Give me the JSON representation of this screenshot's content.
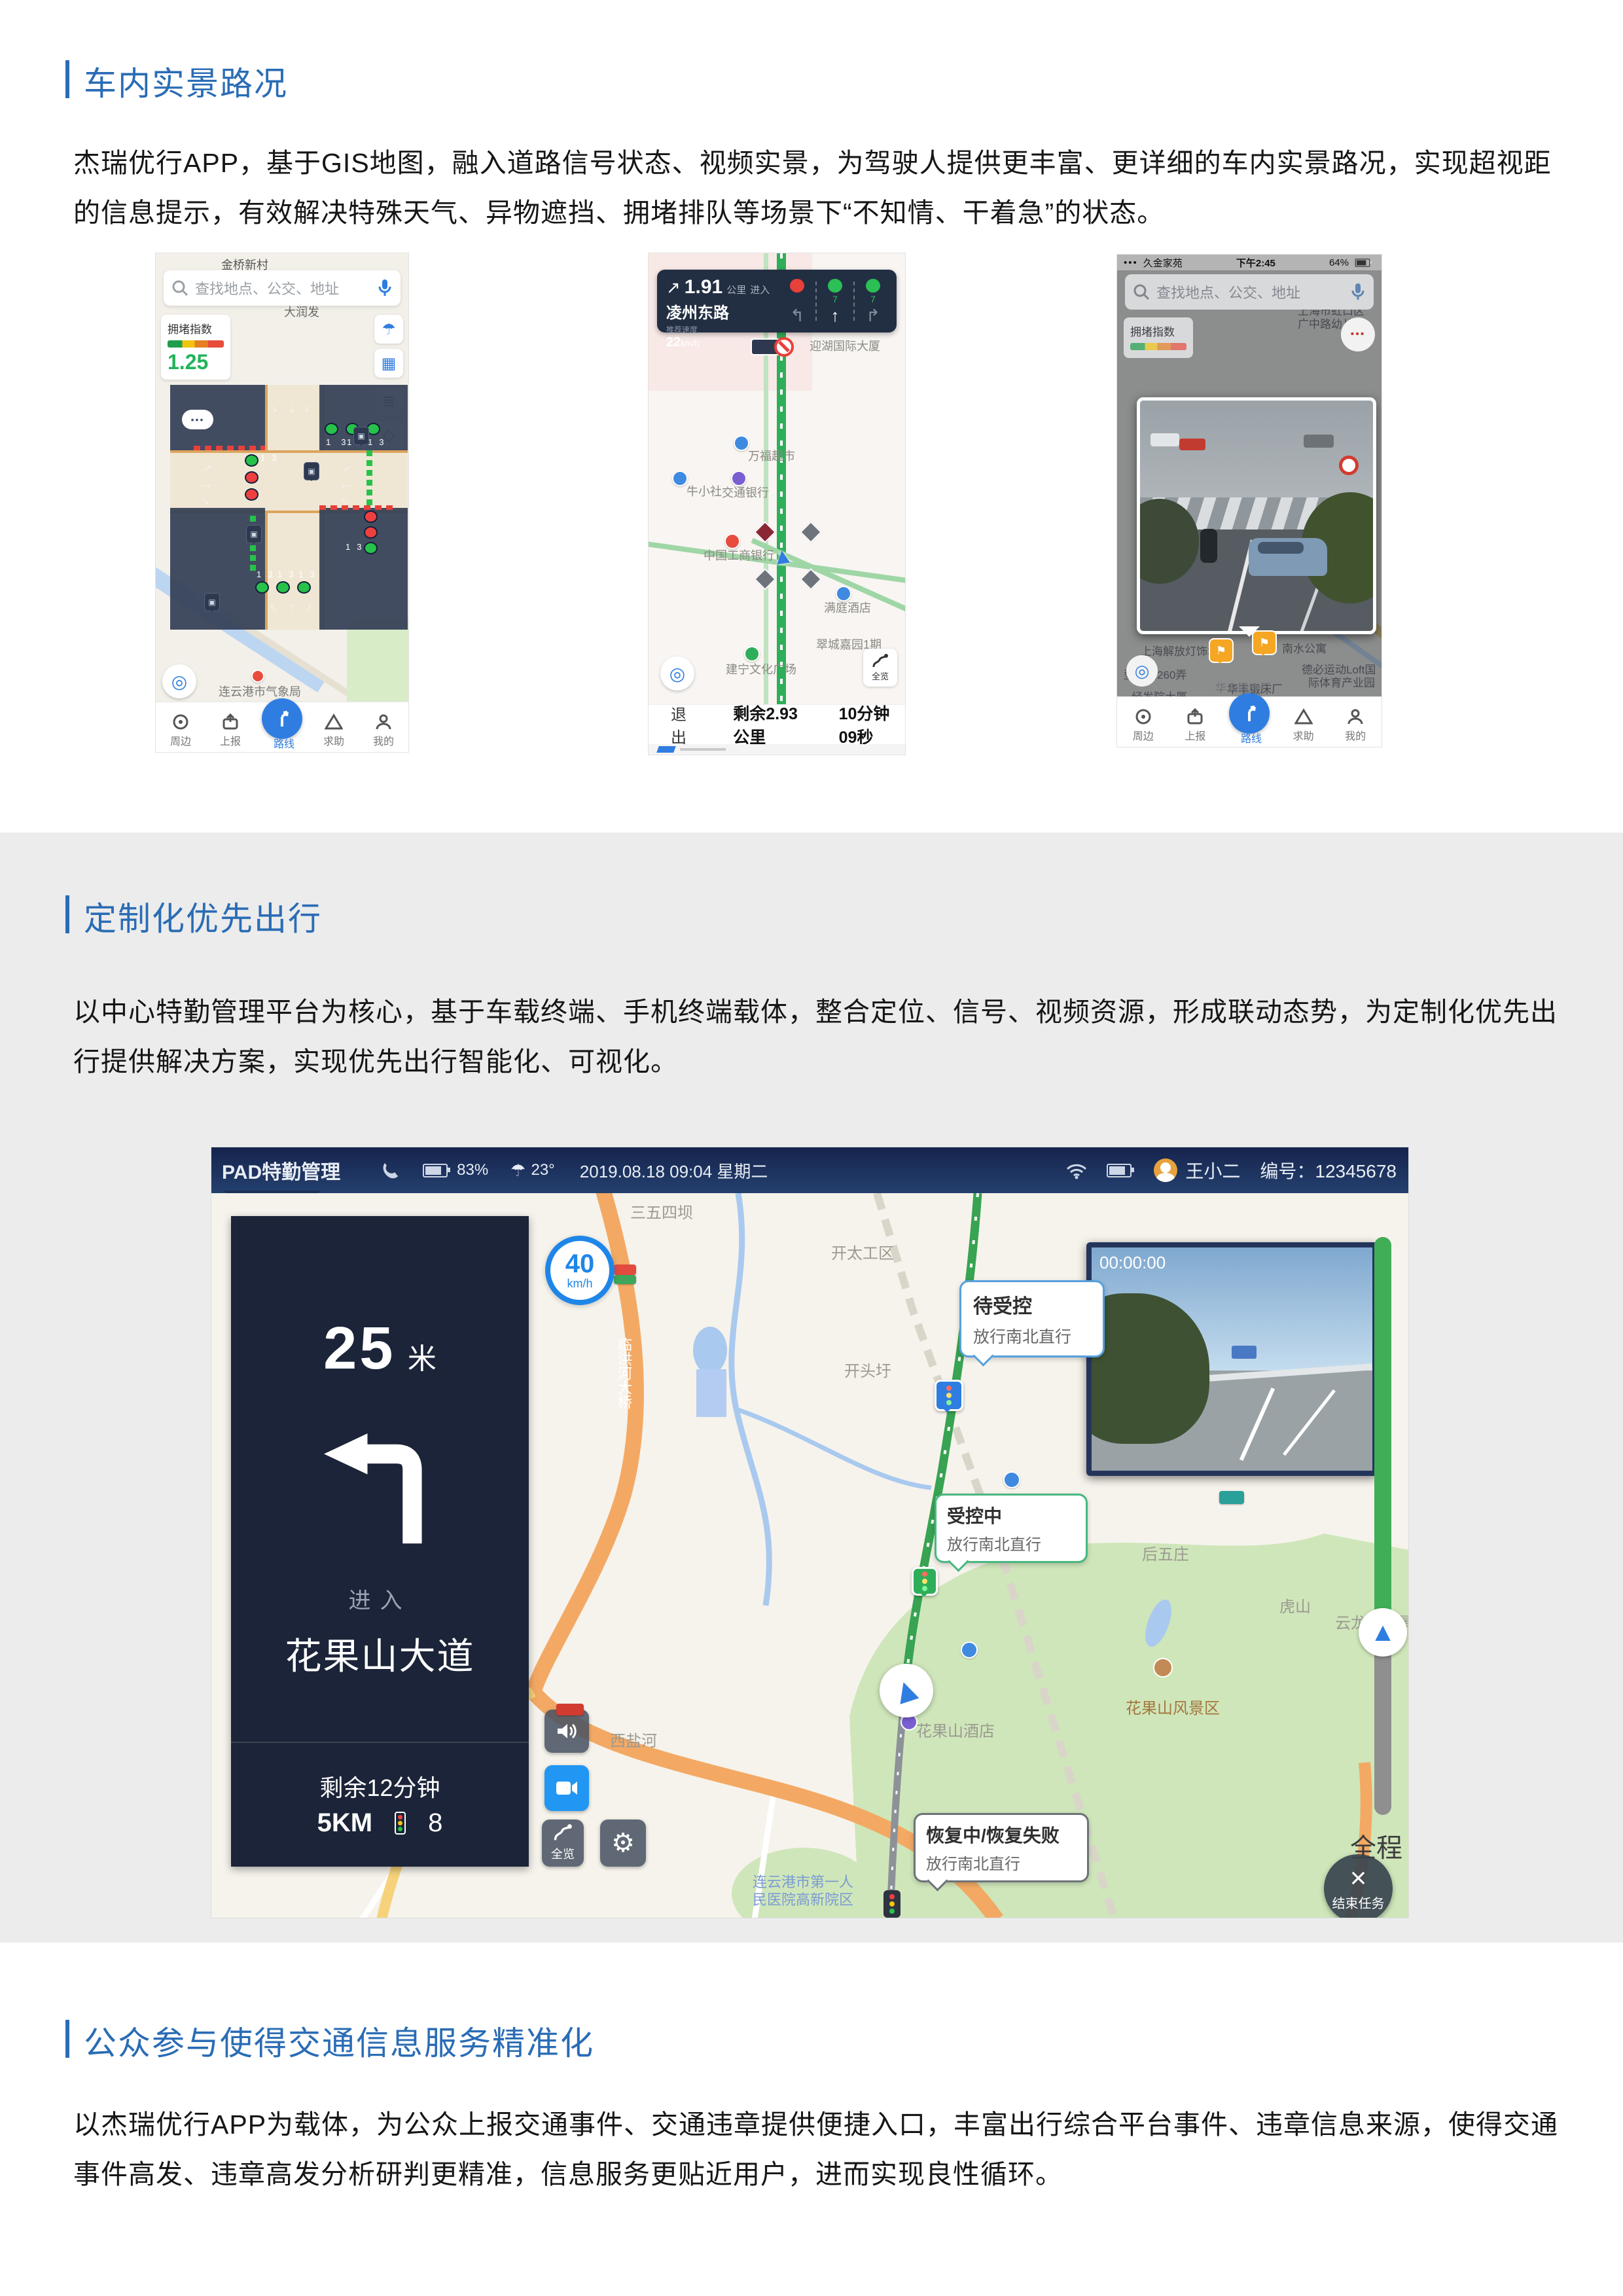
{
  "page": {
    "accent_color": "#2a6cb5",
    "band_color": "#ececec",
    "sections": [
      {
        "title": "车内实景路况",
        "lines": [
          "杰瑞优行APP，基于GIS地图，融入道路信号状态、视频实景，为驾驶人提供更丰富、更详细的车内实景路况，实现超视距",
          "的信息提示，有效解决特殊天气、异物遮挡、拥堵排队等场景下“不知情、干着急”的状态。"
        ]
      },
      {
        "title": "定制化优先出行",
        "lines": [
          "以中心特勤管理平台为核心，基于车载终端、手机终端载体，整合定位、信号、视频资源，形成联动态势，为定制化优先出",
          "行提供解决方案，实现优先出行智能化、可视化。"
        ]
      },
      {
        "title": "公众参与使得交通信息服务精准化",
        "lines": [
          "以杰瑞优行APP为载体，为公众上报交通事件、交通违章提供便捷入口，丰富出行综合平台事件、违章信息来源，使得交通",
          "事件高发、违章高发分析研判更精准，信息服务更贴近用户，进而实现良性循环。"
        ]
      }
    ]
  },
  "phone1": {
    "top_label": "金桥新村",
    "poi_darunfa": "大润发",
    "search_placeholder": "查找地点、公交、地址",
    "congestion_label": "拥堵指数",
    "congestion_value": "1.25",
    "countdown_row": "13  13  13",
    "countdown": "13",
    "weather_poi": "连云港市气象局",
    "scale": "200米",
    "nav": [
      "周边",
      "上报",
      "路线",
      "求助",
      "我的"
    ]
  },
  "phone2": {
    "distance": "1.91",
    "distance_unit": "公里",
    "enter": "进入",
    "road": "凌州东路",
    "speed_label": "推荐速度",
    "speed_value": "22",
    "speed_unit": "km/h",
    "count_mid": "7",
    "count_right": "7",
    "poi_wanfu": "万福超市",
    "poi_niu": "牛小社",
    "poi_bank": "交通银行",
    "poi_icbc": "中国工商银行",
    "poi_hotel": "满庭酒店",
    "poi_yinghu": "迎湖国际大厦",
    "poi_cuicheng": "翠城嘉园1期",
    "poi_jianning": "建宁文化广场",
    "exit": "退出",
    "remain_km": "剩余2.93公里",
    "remain_time": "10分钟09秒",
    "overview": "全览"
  },
  "phone3": {
    "status_left": "久金家苑",
    "status_time": "下午2:45",
    "status_batt": "64%",
    "search_placeholder": "查找地点、公交、地址",
    "congestion_label": "拥堵指数",
    "labels": [
      "上海市虹口区",
      "广中路幼儿园",
      "南水公寓",
      "德必运动Loft国",
      "际体育产业园",
      "上海解放灯饰城",
      "华丰锻床厂",
      "经发院大厦",
      "型关路260弄",
      "金高108创意",
      "广场银座",
      "恒通公寓",
      "飘鹰公寓",
      "新和公寓",
      "上海医疗器械",
      "股份有限公司",
      "广粤路"
    ],
    "nav": [
      "周边",
      "上报",
      "路线",
      "求助",
      "我的"
    ]
  },
  "pad": {
    "title": "PAD特勤管理",
    "battery": "83%",
    "temp": "23°",
    "datetime": "2019.08.18  09:04  星期二",
    "user": "王小二",
    "user_no": "编号：12345678",
    "nav_distance": "25",
    "nav_unit": "米",
    "nav_enter": "进入",
    "nav_road": "花果山大道",
    "remain_time": "剩余12分钟",
    "remain_km": "5KM",
    "light_count": "8",
    "speed": "40",
    "speed_unit": "km/h",
    "video_time": "00:00:00",
    "bubble1_title": "待受控",
    "bubble1_sub": "放行南北直行",
    "bubble2_title": "受控中",
    "bubble2_sub": "放行南北直行",
    "bubble3_title": "恢复中/恢复失败",
    "bubble3_sub": "放行南北直行",
    "progress_label": "全程",
    "end_task": "结束任务",
    "overview": "全览",
    "labels": {
      "a": "三五四坝",
      "b": "开太工区",
      "c": "开头圩",
      "d": "朝阳镇",
      "e": "西盐河",
      "f": "后五庄",
      "g": "虎山",
      "h": "花果山风景区",
      "i": "花果山酒店",
      "j": "云龙涧风景区",
      "k": "临洪河大桥",
      "l": "连云港市第一人",
      "m": "民医院高新院区"
    }
  }
}
